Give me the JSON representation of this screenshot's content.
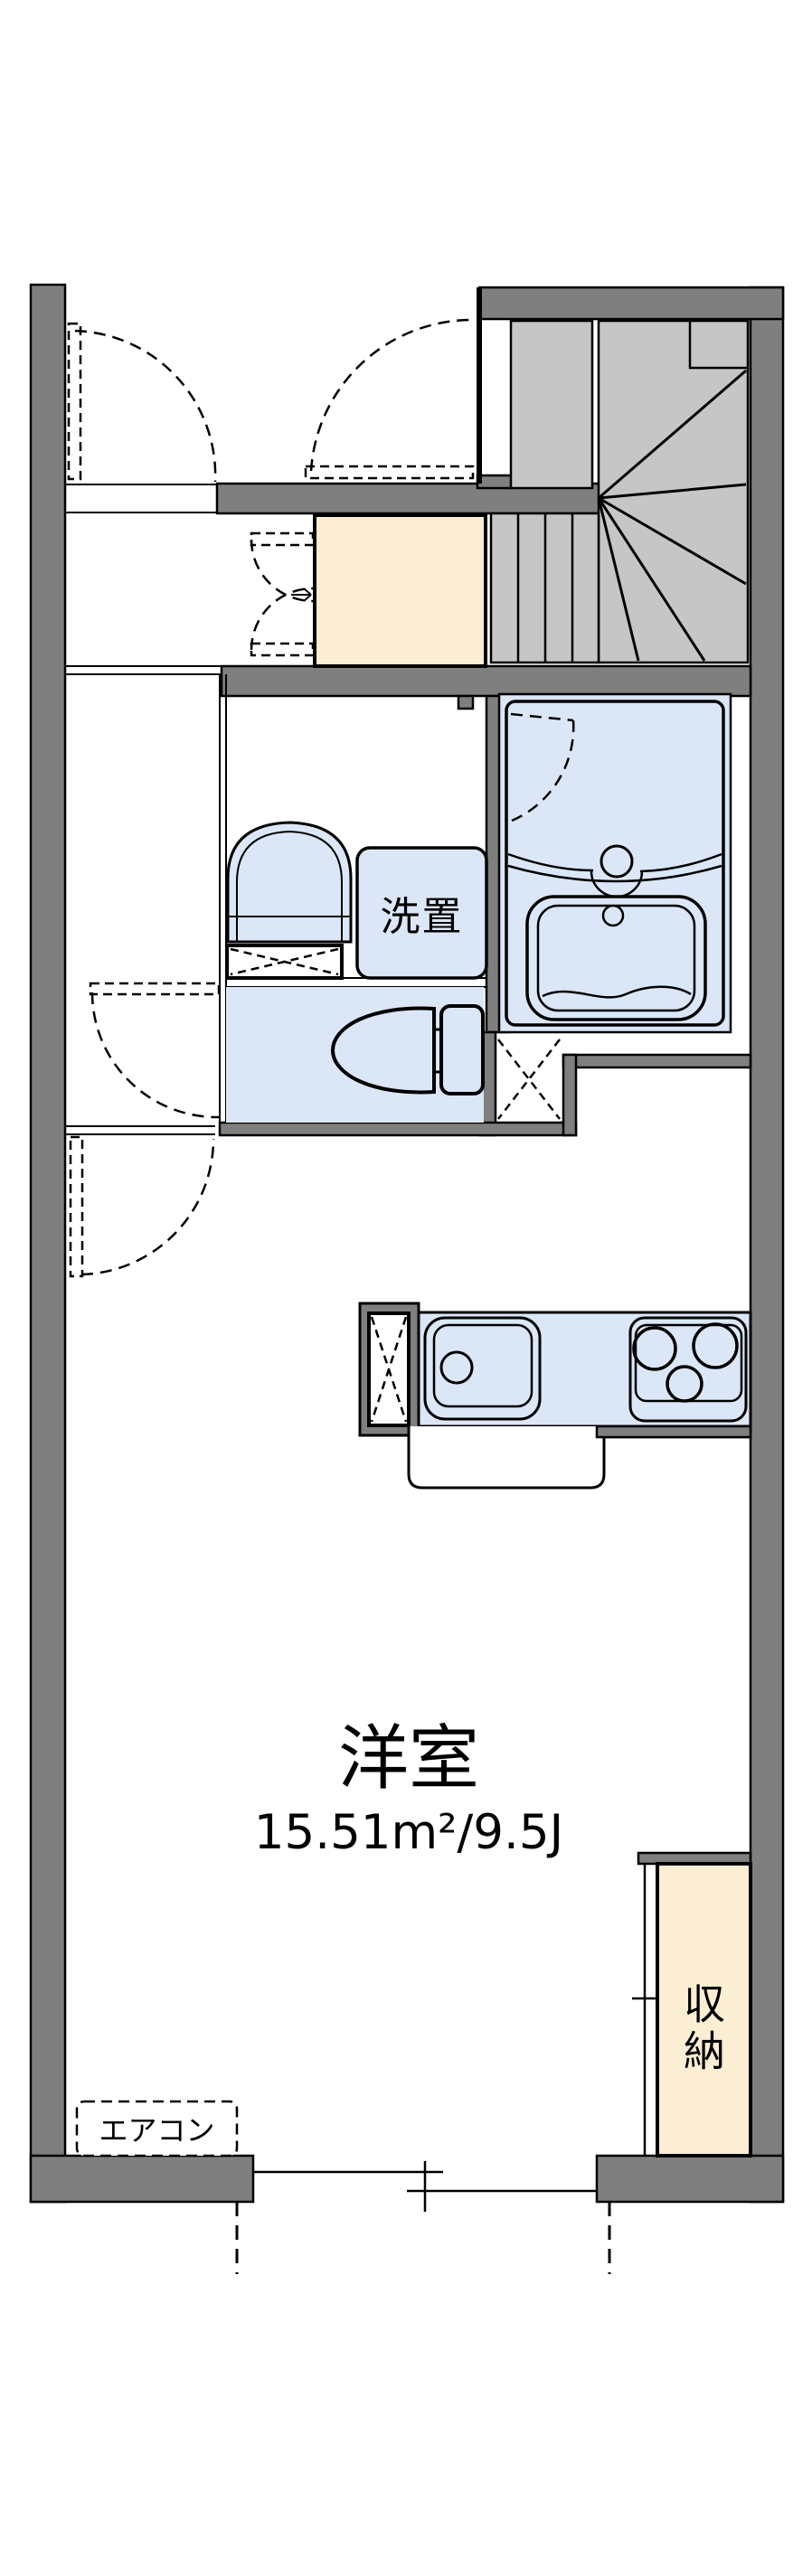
{
  "plan": {
    "type": "apartment-floor-plan",
    "main_room": {
      "name": "洋室",
      "area": "15.51m²/9.5J"
    },
    "labels": {
      "laundry": "洗置",
      "storage": "収納",
      "aircon": "エアコン"
    },
    "features": [
      "staircase",
      "entrance",
      "bathroom",
      "toilet",
      "washbasin",
      "kitchen-sink",
      "stove",
      "refrigerator-space",
      "storage-closet",
      "air-conditioner",
      "sliding-window"
    ],
    "colors": {
      "wall": "#7f7f7f",
      "stair": "#c6c6c6",
      "fixture": "#dbe7f7",
      "entry": "#fbeed2",
      "outline": "#000000",
      "background": "#ffffff"
    }
  }
}
